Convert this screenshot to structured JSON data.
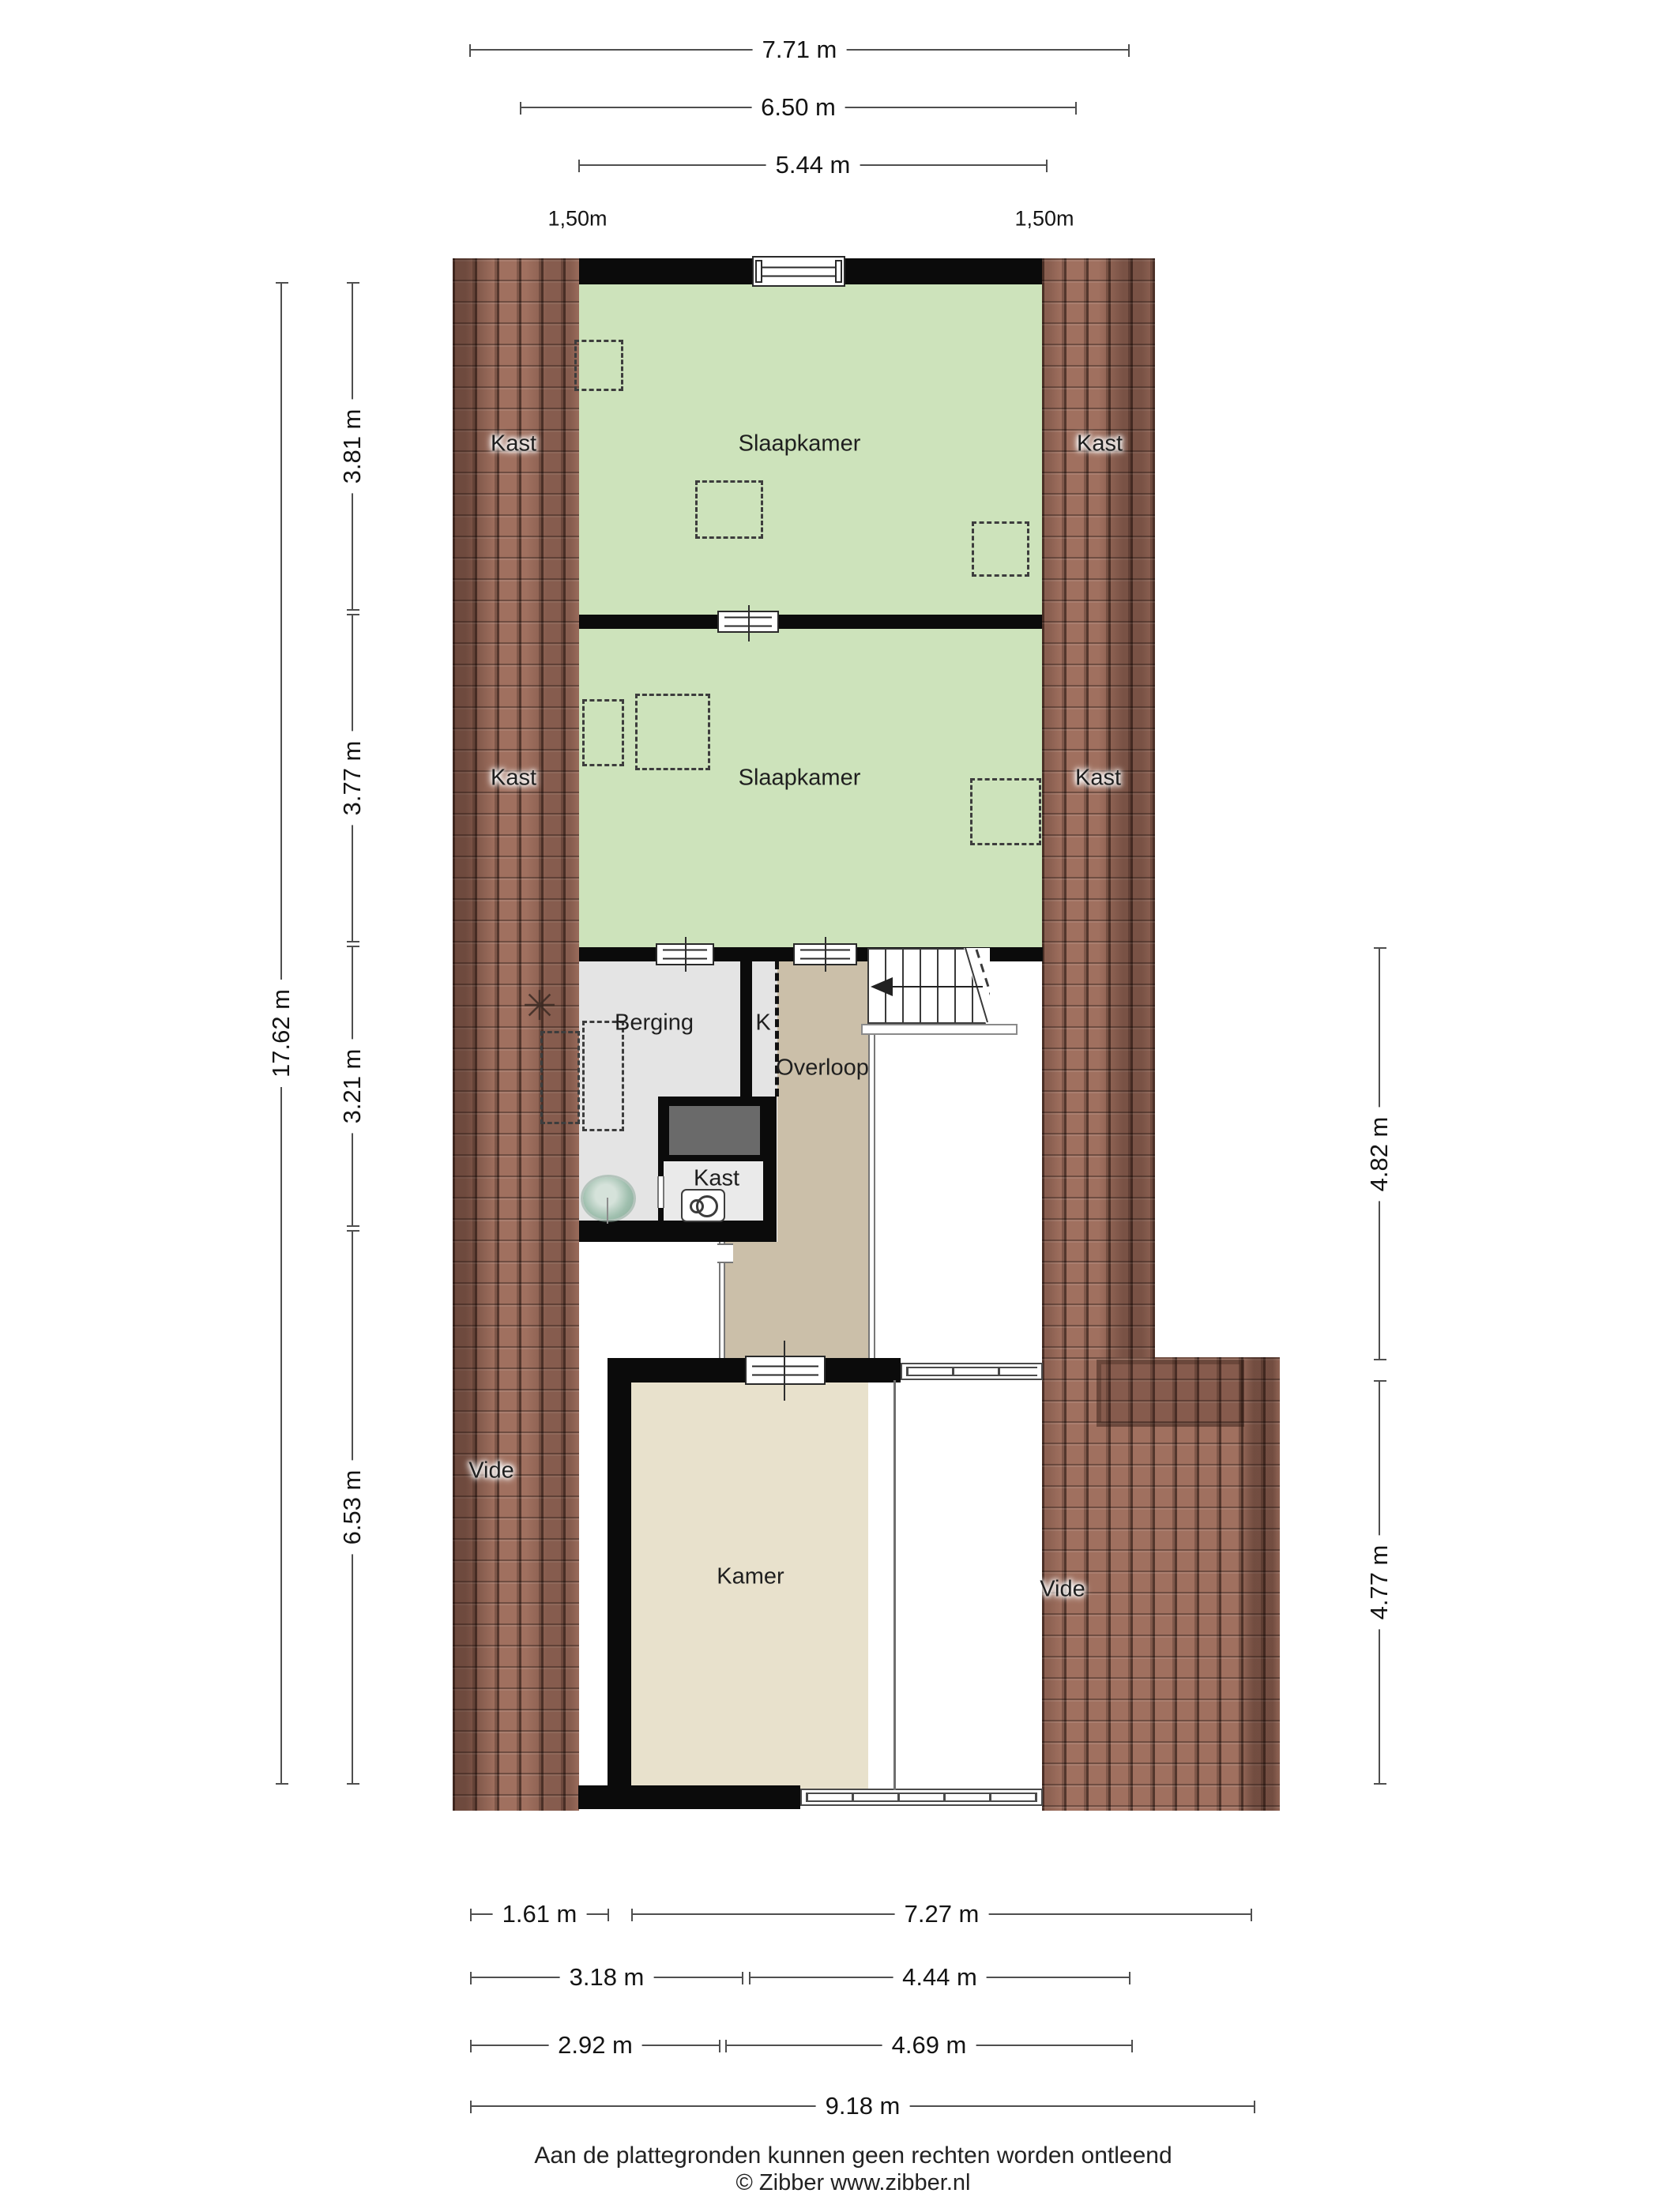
{
  "page": {
    "footer_disclaimer": "Aan de plattegronden kunnen geen rechten worden ontleend",
    "footer_credit": "© Zibber www.zibber.nl"
  },
  "rooms": {
    "slaapkamer_top": "Slaapkamer",
    "slaapkamer_mid": "Slaapkamer",
    "kast_top_left": "Kast",
    "kast_top_right": "Kast",
    "kast_mid_left": "Kast",
    "kast_mid_right": "Kast",
    "berging": "Berging",
    "k_closet": "K",
    "overloop": "Overloop",
    "kast_small": "Kast",
    "kamer": "Kamer",
    "vide_left": "Vide",
    "vide_right": "Vide"
  },
  "dimensions": {
    "top": {
      "d1": "7.71 m",
      "d2": "6.50 m",
      "d3": "5.44 m",
      "offset_left": "1,50m",
      "offset_right": "1,50m"
    },
    "left": {
      "total": "17.62 m",
      "seg1": "3.81 m",
      "seg2": "3.77 m",
      "seg3": "3.21 m",
      "seg4": "6.53 m"
    },
    "right": {
      "seg1": "4.82 m",
      "seg2": "4.77 m"
    },
    "bottom": {
      "r1a": "1.61 m",
      "r1b": "7.27 m",
      "r2a": "3.18 m",
      "r2b": "4.44 m",
      "r3a": "2.92 m",
      "r3b": "4.69 m",
      "r4": "9.18 m"
    }
  },
  "colors": {
    "wall": "#0b0b0b",
    "bedroom_floor": "#cde3bb",
    "storage_floor": "#e4e4e4",
    "corridor_floor": "#cbbfa9",
    "kamer_floor": "#e8e1cc",
    "roof_tiles": "#a0705f",
    "dark_fixture": "#6a6a6a"
  }
}
